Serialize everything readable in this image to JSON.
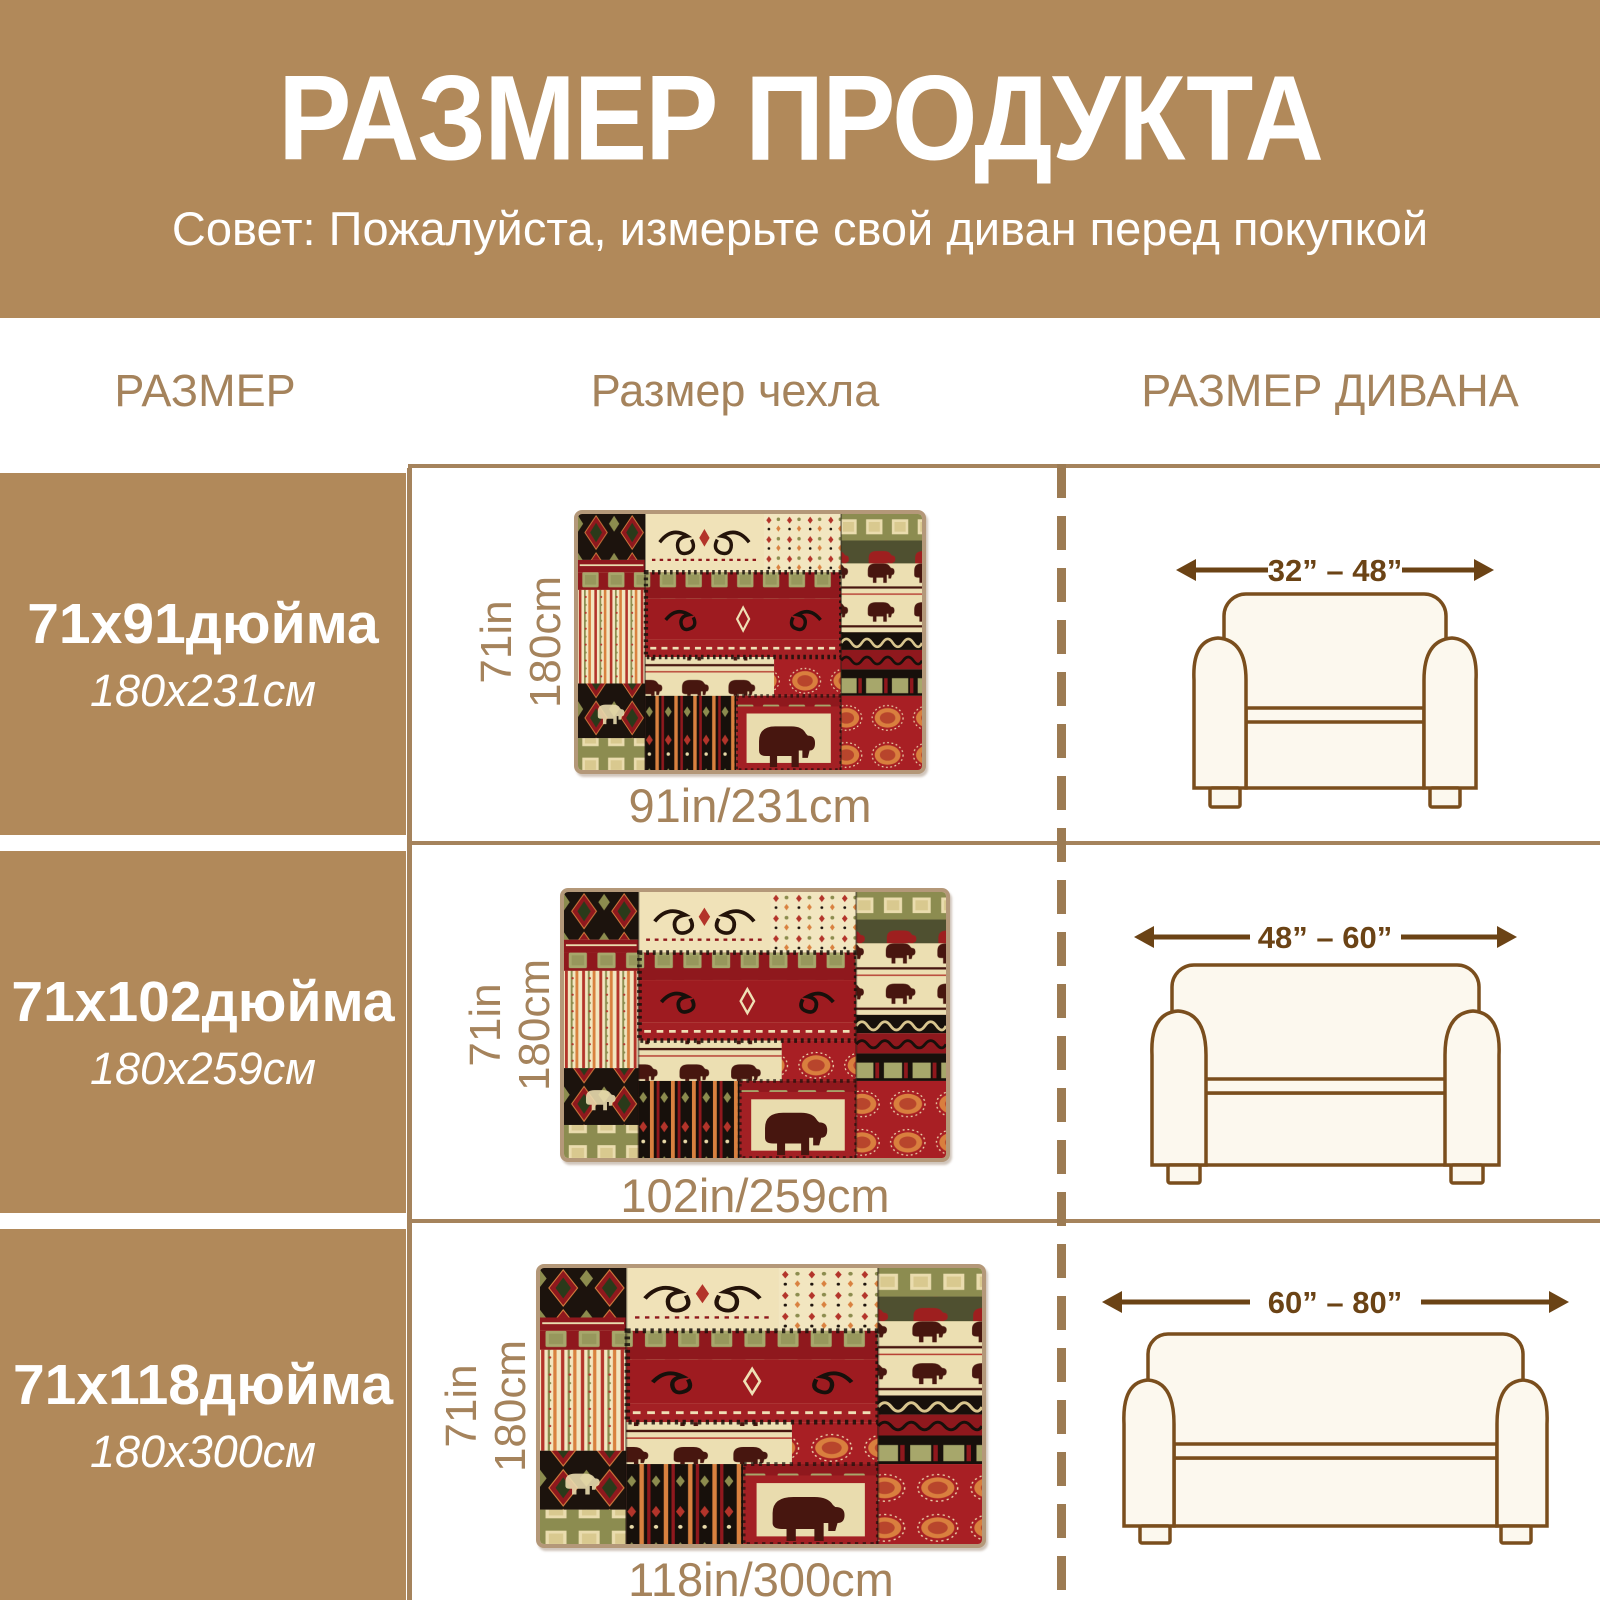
{
  "banner": {
    "title": "РАЗМЕР ПРОДУКТА",
    "subtitle": "Совет: Пожалуйста, измерьте свой диван перед покупкой"
  },
  "columns": {
    "size": "РАЗМЕР",
    "cover": "Размер чехла",
    "sofa": "РАЗМЕР ДИВАНА"
  },
  "rows": [
    {
      "size_inches": "71x91дюйма",
      "size_cm": "180x231см",
      "cover_height_in": "71in",
      "cover_height_cm": "180cm",
      "cover_width": "91in/231cm",
      "sofa_width_range": "32” – 48”"
    },
    {
      "size_inches": "71x102дюйма",
      "size_cm": "180x259см",
      "cover_height_in": "71in",
      "cover_height_cm": "180cm",
      "cover_width": "102in/259cm",
      "sofa_width_range": "48” – 60”"
    },
    {
      "size_inches": "71x118дюйма",
      "size_cm": "180x300см",
      "cover_height_in": "71in",
      "cover_height_cm": "180cm",
      "cover_width": "118in/300cm",
      "sofa_width_range": "60” – 80”"
    }
  ],
  "colors": {
    "banner_brown": "#b1895a",
    "grid_line_brown": "#a5835c",
    "label_brown": "#a5835c",
    "arrow_brown": "#6b4315",
    "sofa_outline": "#7a4e1d",
    "sofa_fill": "#fcf8ee",
    "fabric_red": "#9e1b20",
    "fabric_cream": "#eee1b4",
    "fabric_olive": "#8c8c50",
    "fabric_black": "#17100b",
    "fabric_orange": "#d9813f"
  }
}
